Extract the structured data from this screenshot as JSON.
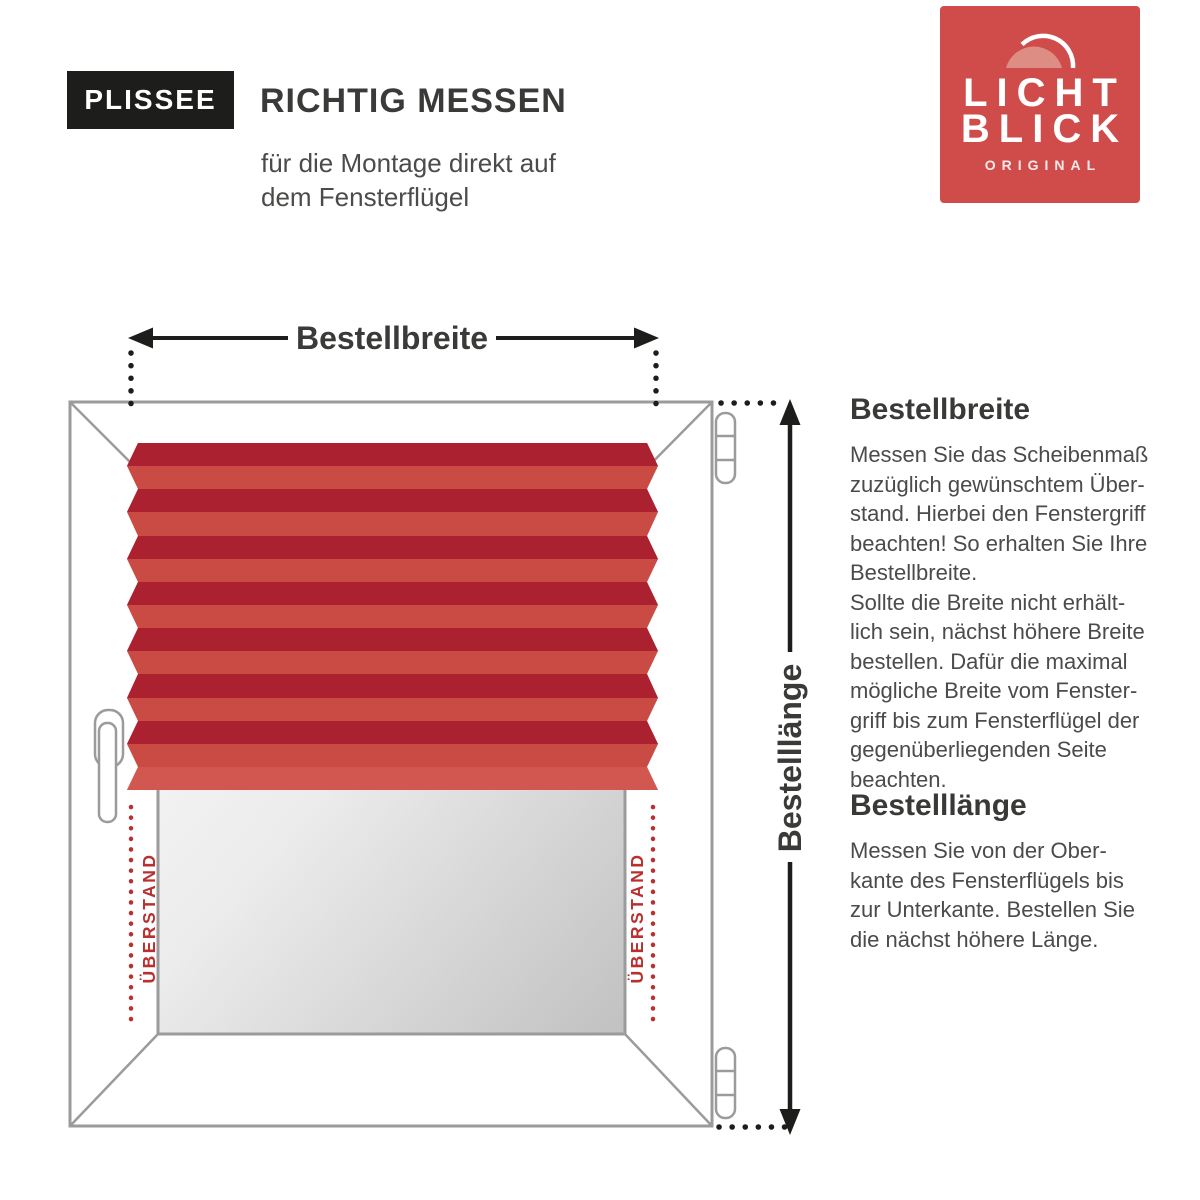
{
  "header": {
    "badge": "PLISSEE",
    "title": "RICHTIG MESSEN",
    "subtitle": "für die Montage direkt auf\ndem Fensterflügel"
  },
  "logo": {
    "word_line1": "LICHT",
    "word_line2": "BLICK",
    "tagline": "ORIGINAL",
    "bg_color": "#d04c4b"
  },
  "diagram": {
    "width_label": "Bestellbreite",
    "length_label": "Bestelllänge",
    "overhang_label_left": "ÜBERSTAND",
    "overhang_label_right": "ÜBERSTAND",
    "colors": {
      "pleat_dark": "#ab2130",
      "pleat_light": "#ca4a44",
      "pleat_bottom": "#d25751",
      "frame_stroke": "#9b9b9b",
      "measure_black": "#1d1d1b",
      "overhang_red": "#b93030",
      "label_dark": "#3a3a39"
    }
  },
  "sections": [
    {
      "heading": "Bestellbreite",
      "body": "Messen Sie das Scheibenmaß\nzuzüglich gewünschtem Über-\nstand. Hierbei den Fenstergriff\nbeachten! So erhalten Sie Ihre\nBestellbreite.\nSollte die Breite nicht erhält-\nlich sein, nächst höhere Breite\nbestellen. Dafür die maximal\nmögliche Breite vom Fenster-\ngriff bis zum Fensterflügel der\ngegenüberliegenden Seite\nbeachten."
    },
    {
      "heading": "Bestelllänge",
      "body": "Messen Sie von der Ober-\nkante des Fensterflügels bis\nzur Unterkante. Bestellen Sie\ndie nächst höhere Länge."
    }
  ]
}
